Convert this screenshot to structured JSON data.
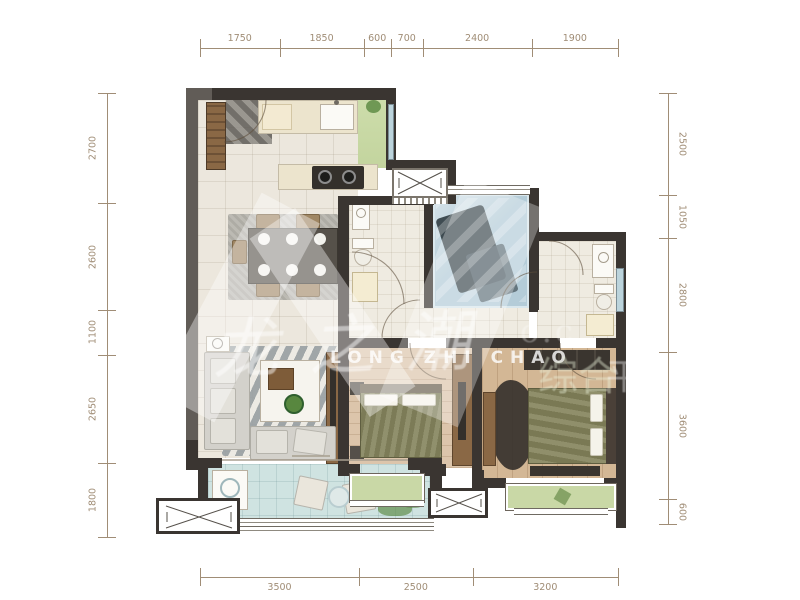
{
  "dimensions": {
    "top": [
      "1750",
      "1850",
      "600",
      "700",
      "2400",
      "1900"
    ],
    "bottom": [
      "3500",
      "2500",
      "3200"
    ],
    "left": [
      "2700",
      "2600",
      "1100",
      "2650",
      "1800"
    ],
    "right": [
      "2500",
      "1050",
      "2800",
      "3600",
      "600"
    ]
  },
  "watermark": {
    "script_text": "龙之潮",
    "latin_text": "LONG ZHI CHAO",
    "side_text_1": "综合",
    "side_text_2": "平",
    "url_fragment": "o.c"
  },
  "colors": {
    "dimension_text": "#a08d76",
    "wall": "#3a3531",
    "tile_floor": "#ece7dd",
    "wood_floor": "#d8c0a4",
    "balcony_floor": "#cfe3e1",
    "green_bay": "#c9d8a6",
    "glass_room": "#b4ccd8",
    "bedding": "#84835c"
  }
}
